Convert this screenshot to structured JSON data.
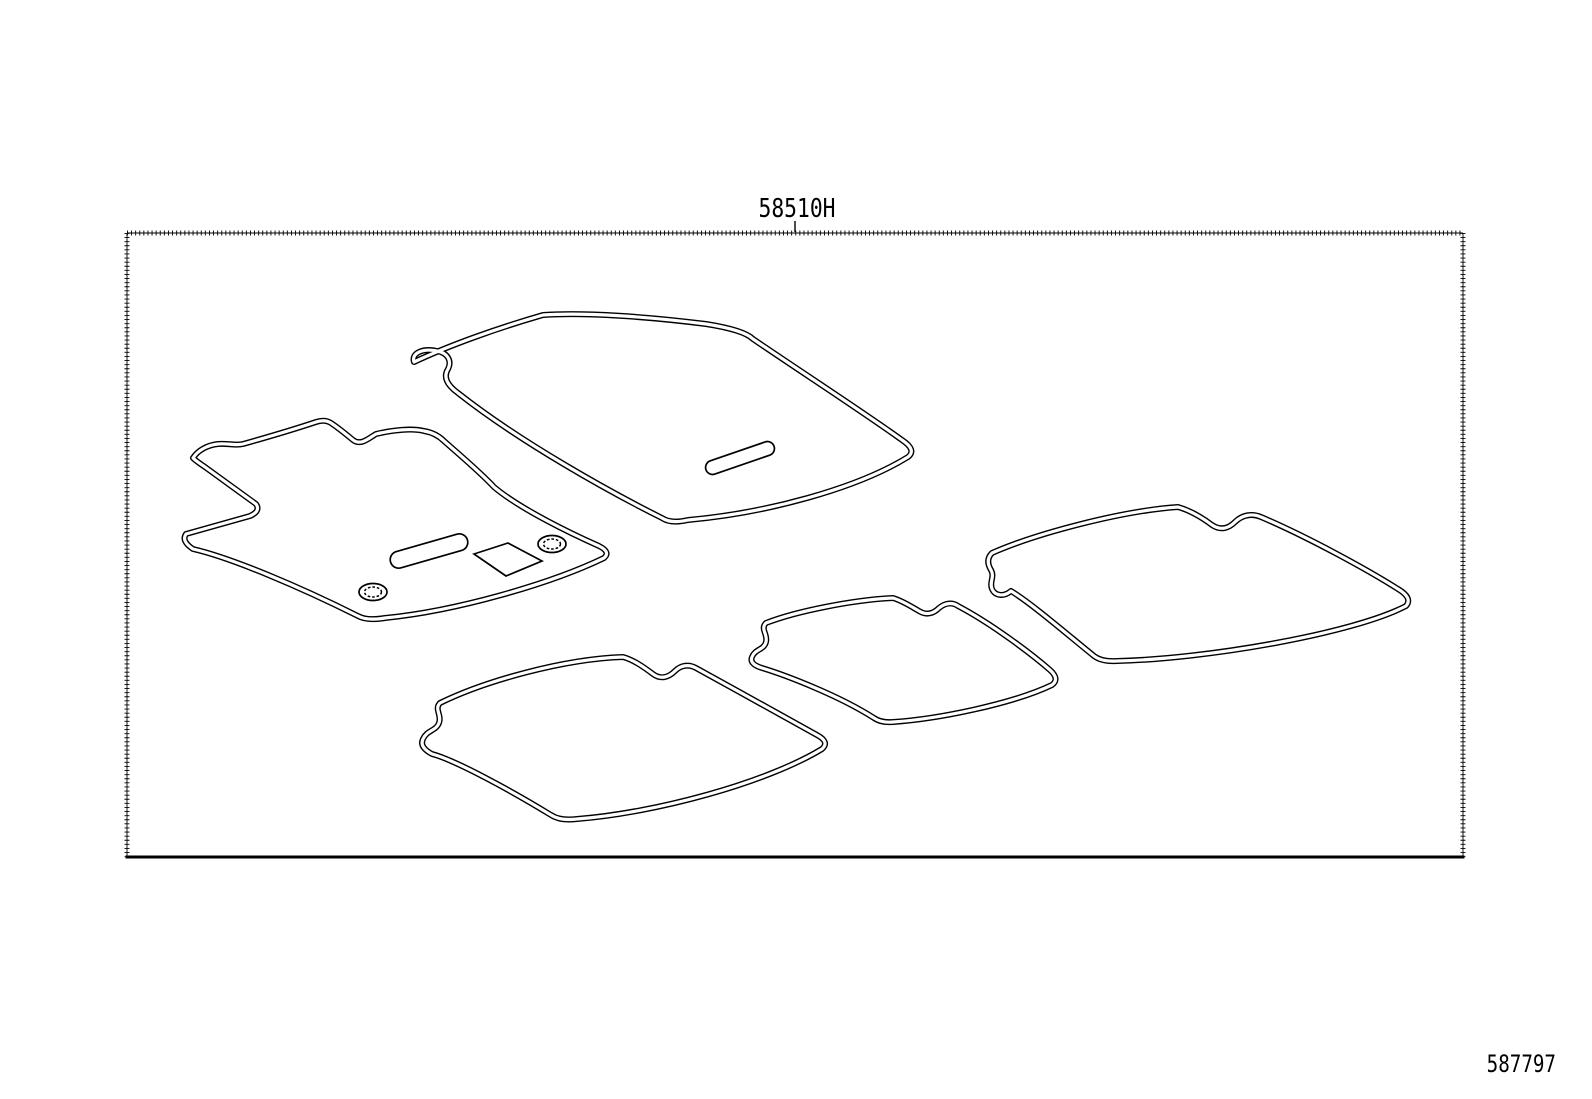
{
  "canvas": {
    "background": "#ffffff",
    "line_color": "#000000"
  },
  "callout": {
    "part_number": "58510H"
  },
  "footer": {
    "figure_number": "587797"
  },
  "diagram": {
    "type": "parts-line-drawing",
    "mats": [
      "front-floor-mat-large",
      "front-floor-mat-driver",
      "rear-floor-mat-right",
      "rear-floor-mat-center",
      "rear-floor-mat-left"
    ]
  }
}
